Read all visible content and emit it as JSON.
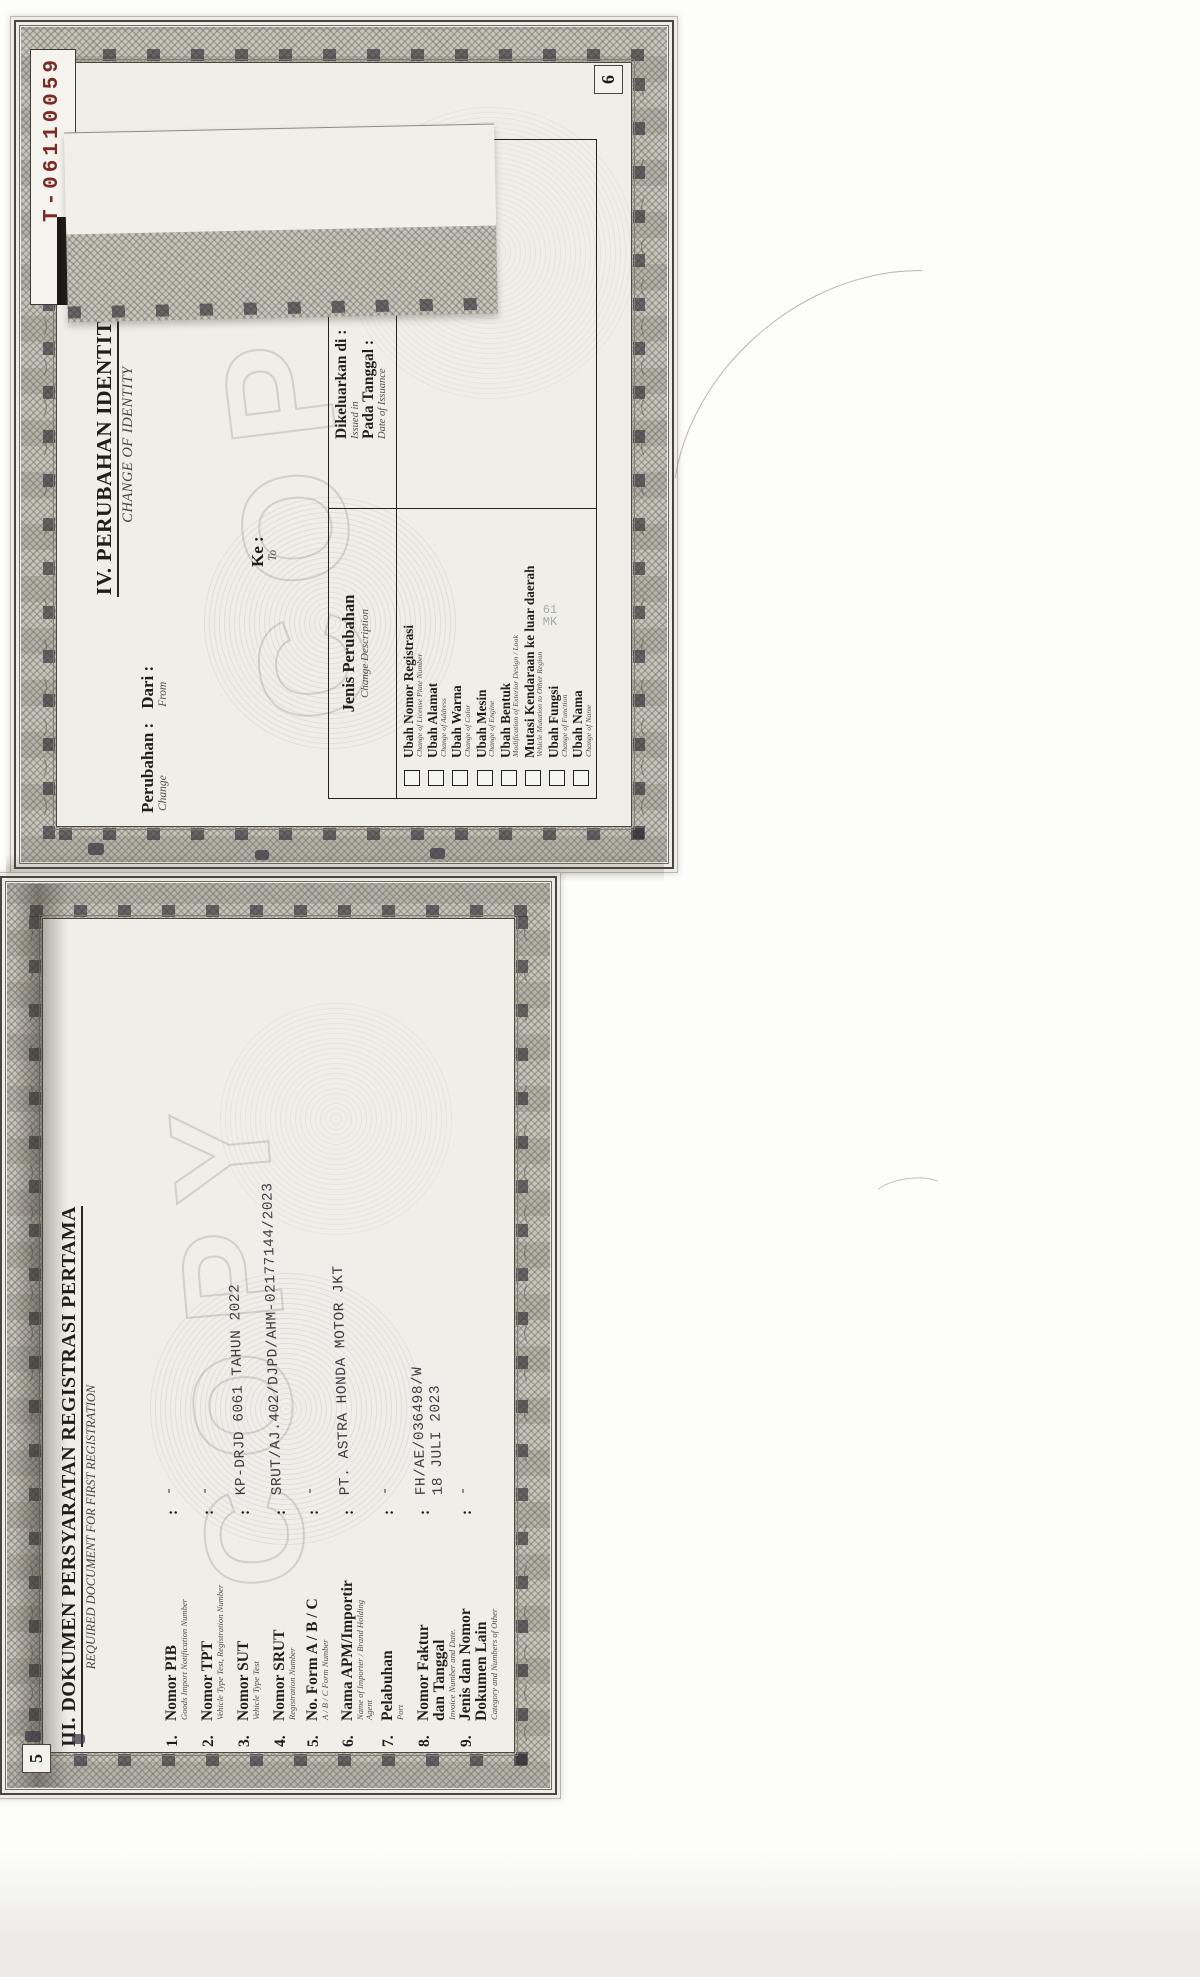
{
  "colors": {
    "accent_red": "#7c2a23",
    "ink": "#211e1a",
    "paper": "#edece6"
  },
  "page6": {
    "serial_label": "No",
    "serial_number": "T-06110059",
    "page_number": "6",
    "title": "IV. PERUBAHAN IDENTITAS",
    "subtitle": "CHANGE OF IDENTITY",
    "perubahan_label": "Perubahan :",
    "change_sub": "Change",
    "dari_label": "Dari :",
    "from_sub": "From",
    "ke_label": "Ke :",
    "to_sub": "To",
    "table": {
      "jenis_header": "Jenis Perubahan",
      "jenis_sub": "Change Description",
      "issued_label": "Dikeluarkan di :",
      "issued_sub": "Issued in",
      "date_label": "Pada Tanggal :",
      "date_sub": "Date of Issuance"
    },
    "checklist": [
      {
        "label": "Ubah Nomor Registrasi",
        "sub": "Change of License Plate Number"
      },
      {
        "label": "Ubah Alamat",
        "sub": "Change of Address"
      },
      {
        "label": "Ubah Warna",
        "sub": "Change of Color"
      },
      {
        "label": "Ubah Mesin",
        "sub": "Change of Engine"
      },
      {
        "label": "Ubah Bentuk",
        "sub": "Modification of Exterior Design / Look"
      },
      {
        "label": "Mutasi Kendaraan ke luar daerah",
        "sub": "Vehicle Mutation to Other Region"
      },
      {
        "label": "Ubah Fungsi",
        "sub": "Change of Function"
      },
      {
        "label": "Ubah Nama",
        "sub": "Change of Name"
      }
    ],
    "watermark": "COPY",
    "artifact_line1": "61",
    "artifact_line2": "MK"
  },
  "page5": {
    "page_number": "5",
    "title": "III. DOKUMEN PERSYARATAN REGISTRASI PERTAMA",
    "subtitle": "REQUIRED DOCUMENT FOR FIRST REGISTRATION",
    "colon": ":",
    "items": [
      {
        "no": "1.",
        "label": "Nomor PIB",
        "label2": "",
        "sub": "Goods Import Notification Number",
        "sub2": "",
        "value": "-",
        "value2": ""
      },
      {
        "no": "2.",
        "label": "Nomor TPT",
        "label2": "",
        "sub": "Vehicle Type Test, Registration Number",
        "sub2": "",
        "value": "-",
        "value2": ""
      },
      {
        "no": "3.",
        "label": "Nomor SUT",
        "label2": "",
        "sub": "Vehicle Type Test",
        "sub2": "",
        "value": "KP-DRJD 6061 TAHUN 2022",
        "value2": ""
      },
      {
        "no": "4.",
        "label": "Nomor SRUT",
        "label2": "",
        "sub": "Registration Number",
        "sub2": "",
        "value": "SRUT/AJ.402/DJPD/AHM-02177144/2023",
        "value2": ""
      },
      {
        "no": "5.",
        "label": "No. Form A / B / C",
        "label2": "",
        "sub": "A / B / C Form Number",
        "sub2": "",
        "value": "-",
        "value2": ""
      },
      {
        "no": "6.",
        "label": "Nama APM/Importir",
        "label2": "",
        "sub": "Name of Importer / Brand Holding",
        "sub2": "Agent",
        "value": "PT. ASTRA HONDA MOTOR JKT",
        "value2": ""
      },
      {
        "no": "7.",
        "label": "Pelabuhan",
        "label2": "",
        "sub": "Port",
        "sub2": "",
        "value": "-",
        "value2": ""
      },
      {
        "no": "8.",
        "label": "Nomor Faktur",
        "label2": "dan Tanggal",
        "sub": "Invoice Number and Date.",
        "sub2": "",
        "value": "FH/AE/036498/W",
        "value2": "18 JULI 2023"
      },
      {
        "no": "9.",
        "label": "Jenis dan Nomor",
        "label2": "Dokumen Lain",
        "sub": "Category and Numbers of Other",
        "sub2": "",
        "value": "-",
        "value2": ""
      }
    ],
    "watermark": "COPY"
  }
}
